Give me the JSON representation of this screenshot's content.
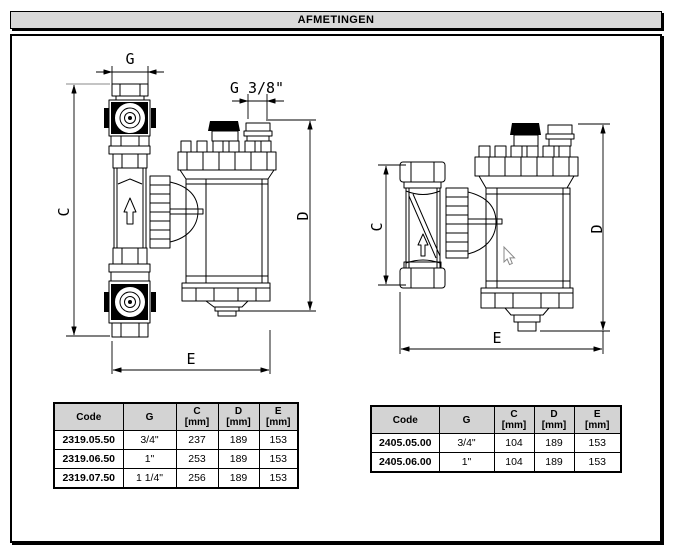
{
  "page": {
    "title": "AFMETINGEN"
  },
  "drawings": {
    "left": {
      "dims": {
        "g": "G",
        "g38": "G 3/8\"",
        "c": "C",
        "d": "D",
        "e": "E"
      }
    },
    "right": {
      "dims": {
        "c": "C",
        "d": "D",
        "e": "E"
      }
    }
  },
  "icons": {
    "cursor": "mouse-pointer-icon",
    "flow": "flow-direction-arrow-icon"
  },
  "colors": {
    "titlebar_bg": "#d9d9d9",
    "table_header_bg": "#d3d3d3",
    "line": "#000000",
    "cursor_outline": "#888888"
  },
  "tables": {
    "left": {
      "headers": {
        "code": "Code",
        "g": "G",
        "c": {
          "label": "C",
          "unit": "[mm]"
        },
        "d": {
          "label": "D",
          "unit": "[mm]"
        },
        "e": {
          "label": "E",
          "unit": "[mm]"
        }
      },
      "rows": [
        {
          "code": "2319.05.50",
          "g": "3/4\"",
          "c": "237",
          "d": "189",
          "e": "153"
        },
        {
          "code": "2319.06.50",
          "g": "1\"",
          "c": "253",
          "d": "189",
          "e": "153"
        },
        {
          "code": "2319.07.50",
          "g": "1 1/4\"",
          "c": "256",
          "d": "189",
          "e": "153"
        }
      ]
    },
    "right": {
      "headers": {
        "code": "Code",
        "g": "G",
        "c": {
          "label": "C",
          "unit": "[mm]"
        },
        "d": {
          "label": "D",
          "unit": "[mm]"
        },
        "e": {
          "label": "E",
          "unit": "[mm]"
        }
      },
      "rows": [
        {
          "code": "2405.05.00",
          "g": "3/4\"",
          "c": "104",
          "d": "189",
          "e": "153"
        },
        {
          "code": "2405.06.00",
          "g": "1\"",
          "c": "104",
          "d": "189",
          "e": "153"
        }
      ]
    }
  }
}
